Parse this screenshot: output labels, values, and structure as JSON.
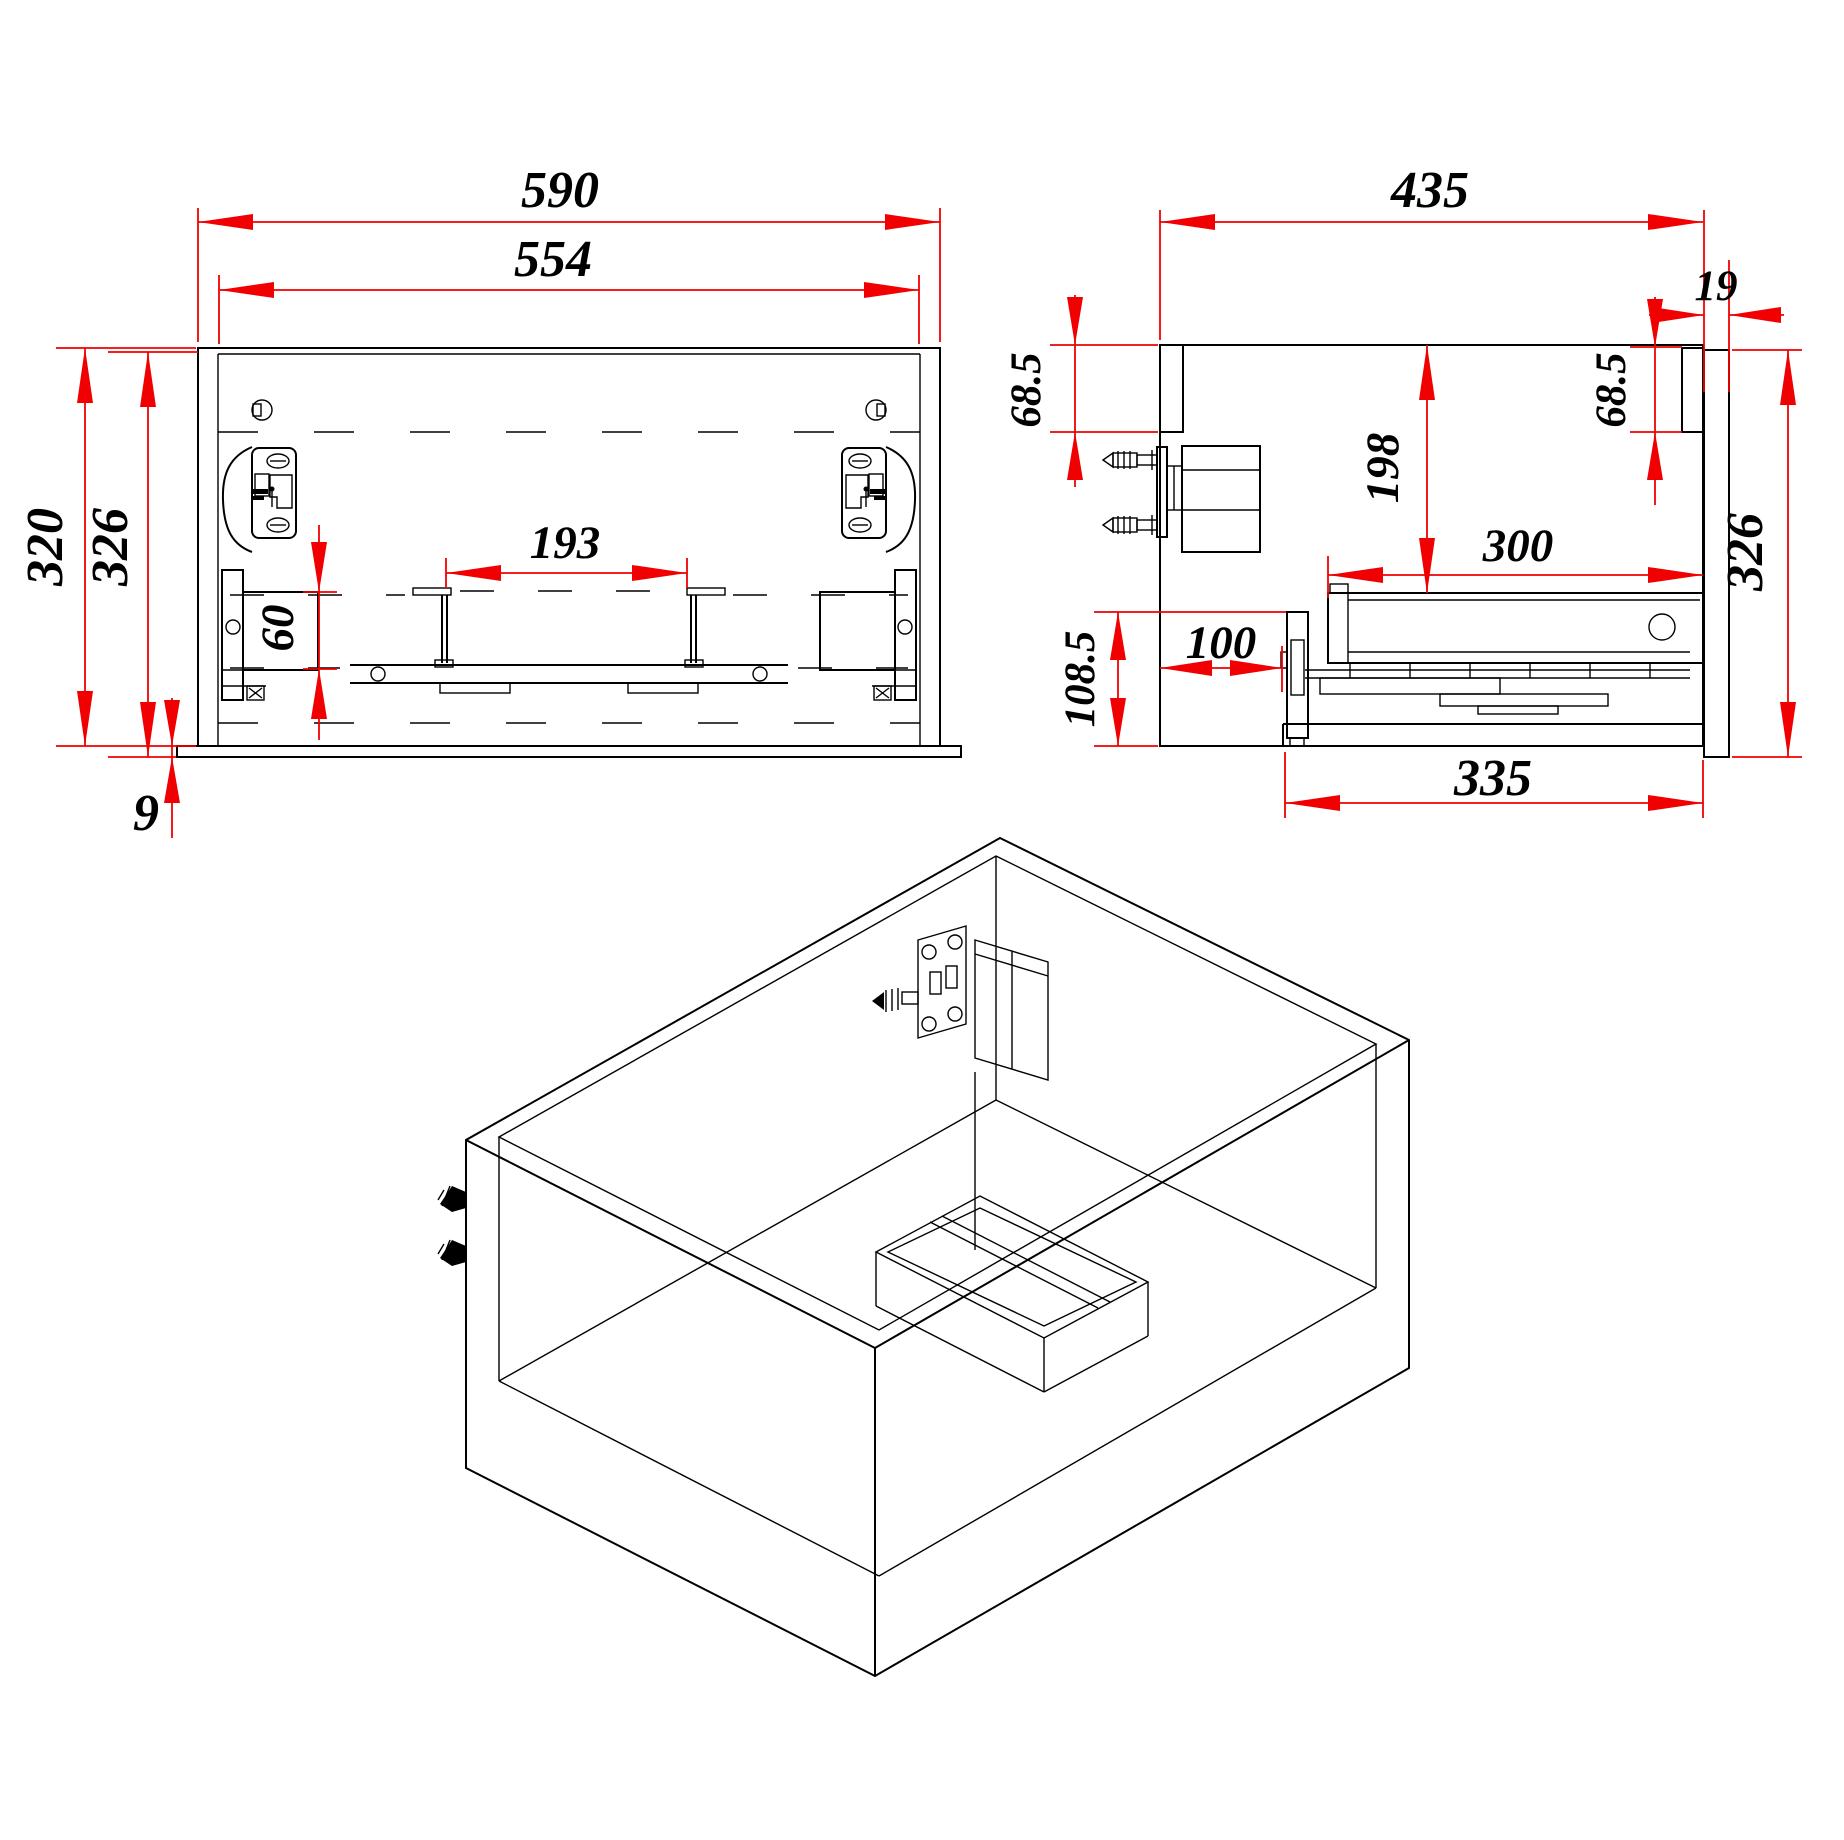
{
  "drawing": {
    "type": "furniture_technical_drawing",
    "subject": "wall-hung vanity drawer cabinet",
    "background_color": "#ffffff",
    "line_color": "#000000",
    "dimension_color": "#f00000",
    "views": {
      "front": {
        "name": "front view"
      },
      "side": {
        "name": "side section view"
      },
      "isometric": {
        "name": "isometric view"
      }
    }
  },
  "dims": {
    "front_outer_width": "590",
    "front_inner_width": "554",
    "front_outer_height": "320",
    "front_panel_height": "326",
    "front_bottom_overhang": "9",
    "front_bracket_spacing": "193",
    "front_bracket_height": "60",
    "side_total_depth": "435",
    "side_front_panel_thickness": "19",
    "side_back_rail_height": "68.5",
    "side_front_rail_height": "68.5",
    "side_drawer_top_offset": "198",
    "side_drawer_depth": "300",
    "side_back_clearance": "100",
    "side_clearance_height": "108.5",
    "side_panel_height": "326",
    "side_bottom_depth": "335"
  }
}
